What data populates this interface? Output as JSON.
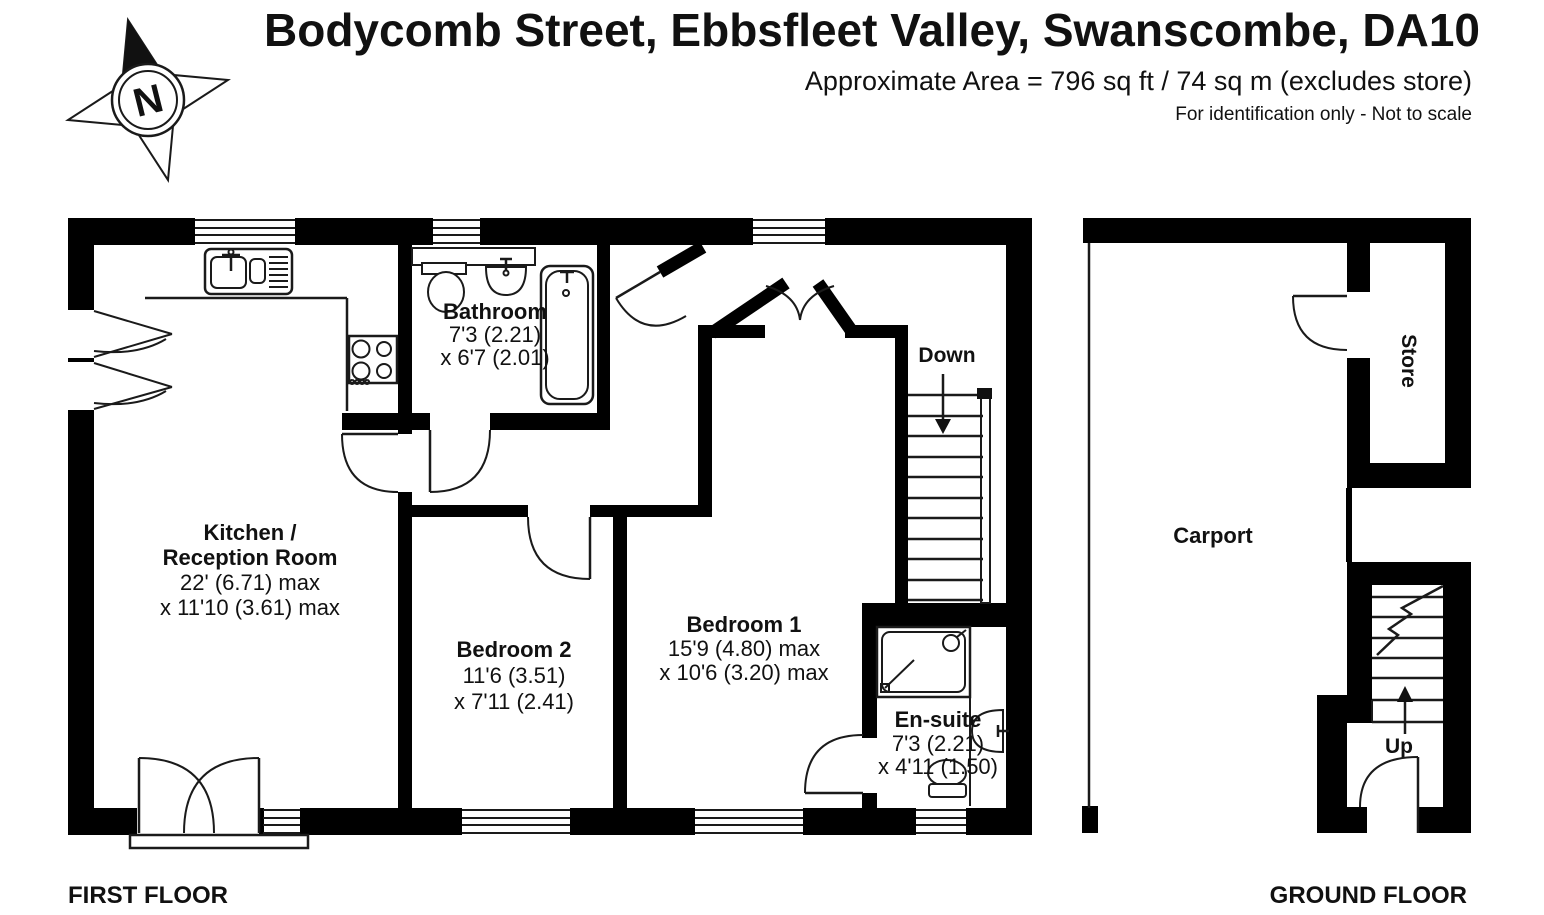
{
  "header": {
    "title": "Bodycomb Street, Ebbsfleet Valley, Swanscombe, DA10",
    "area_line": "Approximate Area = 796 sq ft / 74 sq m (excludes store)",
    "disclaimer": "For identification only - Not to scale"
  },
  "compass": {
    "label": "N"
  },
  "first_floor": {
    "caption": "FIRST FLOOR",
    "rooms": {
      "kitchen": {
        "name_line1": "Kitchen /",
        "name_line2": "Reception Room",
        "dim1": "22' (6.71) max",
        "dim2": "x 11'10 (3.61) max"
      },
      "bathroom": {
        "name": "Bathroom",
        "dim1": "7'3 (2.21)",
        "dim2": "x 6'7 (2.01)"
      },
      "bedroom2": {
        "name": "Bedroom 2",
        "dim1": "11'6 (3.51)",
        "dim2": "x 7'11 (2.41)"
      },
      "bedroom1": {
        "name": "Bedroom 1",
        "dim1": "15'9 (4.80) max",
        "dim2": "x 10'6 (3.20) max"
      },
      "ensuite": {
        "name": "En-suite",
        "dim1": "7'3 (2.21)",
        "dim2": "x 4'11 (1.50)"
      },
      "stairs": {
        "label": "Down"
      }
    }
  },
  "ground_floor": {
    "caption": "GROUND FLOOR",
    "rooms": {
      "carport": {
        "name": "Carport"
      },
      "store": {
        "name": "Store"
      },
      "stairs": {
        "label": "Up"
      }
    }
  },
  "colors": {
    "wall": "#000000",
    "text": "#111111",
    "background": "#ffffff"
  }
}
